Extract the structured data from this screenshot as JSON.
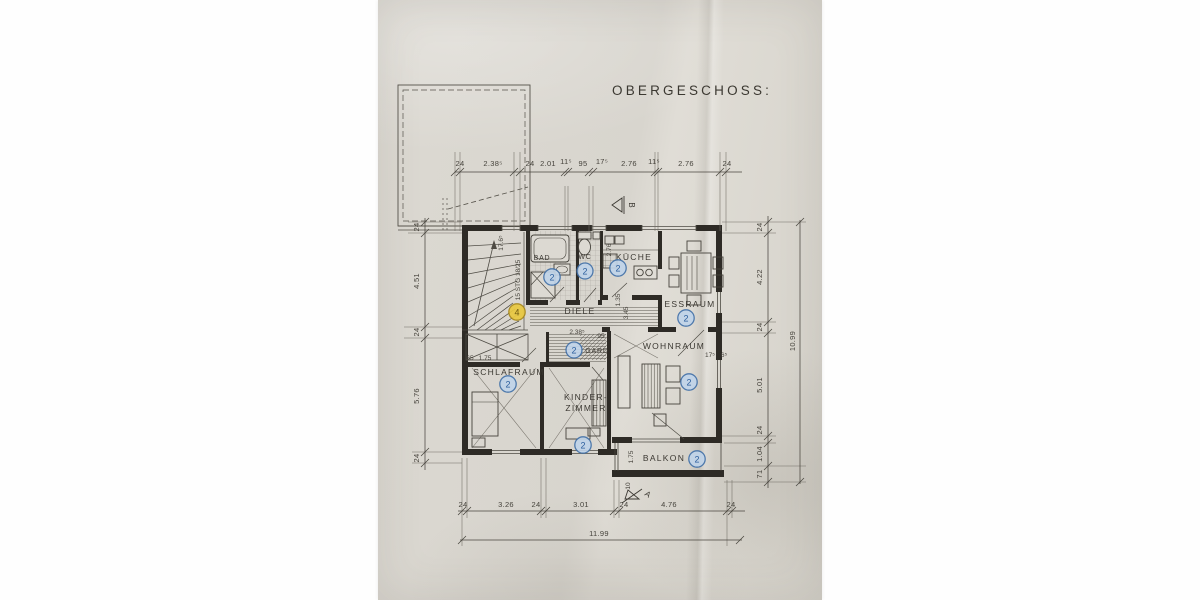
{
  "document": {
    "title": "OBERGESCHOSS:"
  },
  "rooms": {
    "bad": {
      "label": "BAD",
      "badge": "2"
    },
    "wc": {
      "label": "WC",
      "badge": "2"
    },
    "kueche": {
      "label": "KÜCHE",
      "badge": "2"
    },
    "essraum": {
      "label": "ESSRAUM",
      "badge": "2"
    },
    "diele": {
      "label": "DIELE"
    },
    "gard": {
      "label": "GARD",
      "badge": "2"
    },
    "wohnraum": {
      "label": "WOHNRAUM",
      "badge": "2"
    },
    "schlafraum": {
      "label": "SCHLAFRAUM",
      "badge": "2"
    },
    "kinderzimmer": {
      "label_line1": "KINDER-",
      "label_line2": "ZIMMER",
      "badge": "2"
    },
    "balkon": {
      "label": "BALKON",
      "badge": "2"
    },
    "treppenhaus": {
      "badge": "4",
      "stair_note": "15 STG 18/25"
    }
  },
  "dims": {
    "top": [
      "24",
      "2.38⁵",
      "24",
      "2.01",
      "11⁵",
      "95",
      "17⁵",
      "2.76",
      "11⁵",
      "2.76",
      "24"
    ],
    "left": [
      "24",
      "4.51",
      "24",
      "5.76",
      "24"
    ],
    "right": [
      "24",
      "4.22",
      "24",
      "5.01",
      "24",
      "1.04",
      "71"
    ],
    "right_total": "10.99",
    "bottom": [
      "24",
      "3.26",
      "24",
      "3.01",
      "24",
      "4.76",
      "24"
    ],
    "bottom_total": "11.99",
    "stairwell_width": "17.6⁵",
    "kueche_depth": "2.76",
    "diele_width": "2.38⁵",
    "diele_width_small": "95",
    "flur_v1": "1.35",
    "flur_v2": "3.45",
    "schlafraum_pier": "65",
    "schlafraum_window": "1.75",
    "wohnraum_pier": "17⁵",
    "wohnraum_pier2": "6⁵",
    "balkon_depth": "1.75",
    "balkon_parapet": "10"
  },
  "markers": {
    "section_a": "A",
    "section_b": "B"
  },
  "colors": {
    "paper": "#d9d6cf",
    "ink": "#3c3933",
    "wall": "#2e2b26",
    "badge_blue": "#3f6fa8",
    "badge_blue_fill": "#c0d4ea",
    "badge_yellow_fill": "#e9c83f",
    "badge_yellow_stroke": "#a8881c"
  }
}
